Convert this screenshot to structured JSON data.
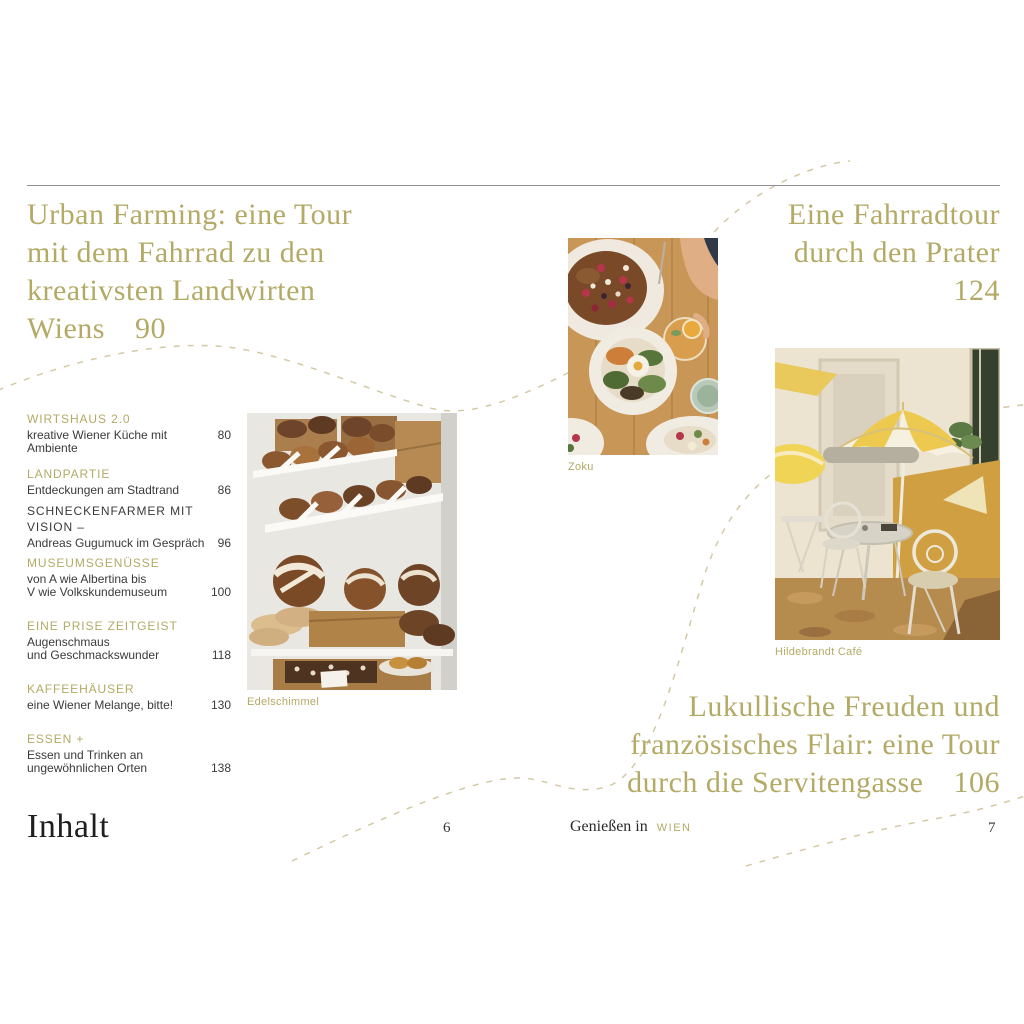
{
  "colors": {
    "accent_gold": "#b3aa66",
    "body_text": "#3a3a3a",
    "rule_gray": "#8f8f8f",
    "dash_tan": "#d3c9a4"
  },
  "headlines": {
    "top_left": {
      "lines": [
        "Urban Farming: eine Tour",
        "mit dem Fahrrad zu den",
        "kreativsten Landwirten"
      ],
      "last_line": "Wiens",
      "page": "90"
    },
    "top_right": {
      "lines": [
        "Eine Fahrradtour",
        "durch den Prater"
      ],
      "page": "124"
    },
    "bottom_right": {
      "lines": [
        "Lukullische Freuden und",
        "französisches Flair: eine Tour"
      ],
      "last_line": "durch die Servitengasse",
      "page": "106"
    }
  },
  "toc": {
    "entries": [
      {
        "title": "WIRTSHAUS 2.0",
        "accent": true,
        "lines": [
          "kreative Wiener Küche mit Ambiente"
        ],
        "page": "80"
      },
      {
        "title": "LANDPARTIE",
        "accent": true,
        "lines": [
          "Entdeckungen am Stadtrand"
        ],
        "page": "86"
      },
      {
        "title": "SCHNECKENFARMER MIT VISION –",
        "accent": false,
        "lines": [
          "Andreas Gugumuck im Gespräch"
        ],
        "page": "96"
      },
      {
        "title": "MUSEUMSGENÜSSE",
        "accent": true,
        "lines": [
          "von A wie Albertina bis",
          "V wie Volkskundemuseum"
        ],
        "page": "100"
      },
      {
        "title": "EINE PRISE ZEITGEIST",
        "accent": true,
        "lines": [
          "Augenschmaus",
          "und Geschmackswunder"
        ],
        "page": "118"
      },
      {
        "title": "KAFFEEHÄUSER",
        "accent": true,
        "lines": [
          "eine Wiener Melange, bitte!"
        ],
        "page": "130"
      },
      {
        "title": "ESSEN +",
        "accent": true,
        "lines": [
          "Essen und Trinken an",
          "ungewöhnlichen Orten"
        ],
        "page": "138"
      }
    ]
  },
  "photos": {
    "zoku": {
      "caption": "Zoku"
    },
    "edelschimmel": {
      "caption": "Edelschimmel"
    },
    "hildebrandt": {
      "caption": "Hildebrandt Café"
    }
  },
  "footer": {
    "contents_label": "Inhalt",
    "left_page_number": "6",
    "right_page_number": "7",
    "running_title": "Genießen in",
    "running_title_accent": "WIEN"
  }
}
